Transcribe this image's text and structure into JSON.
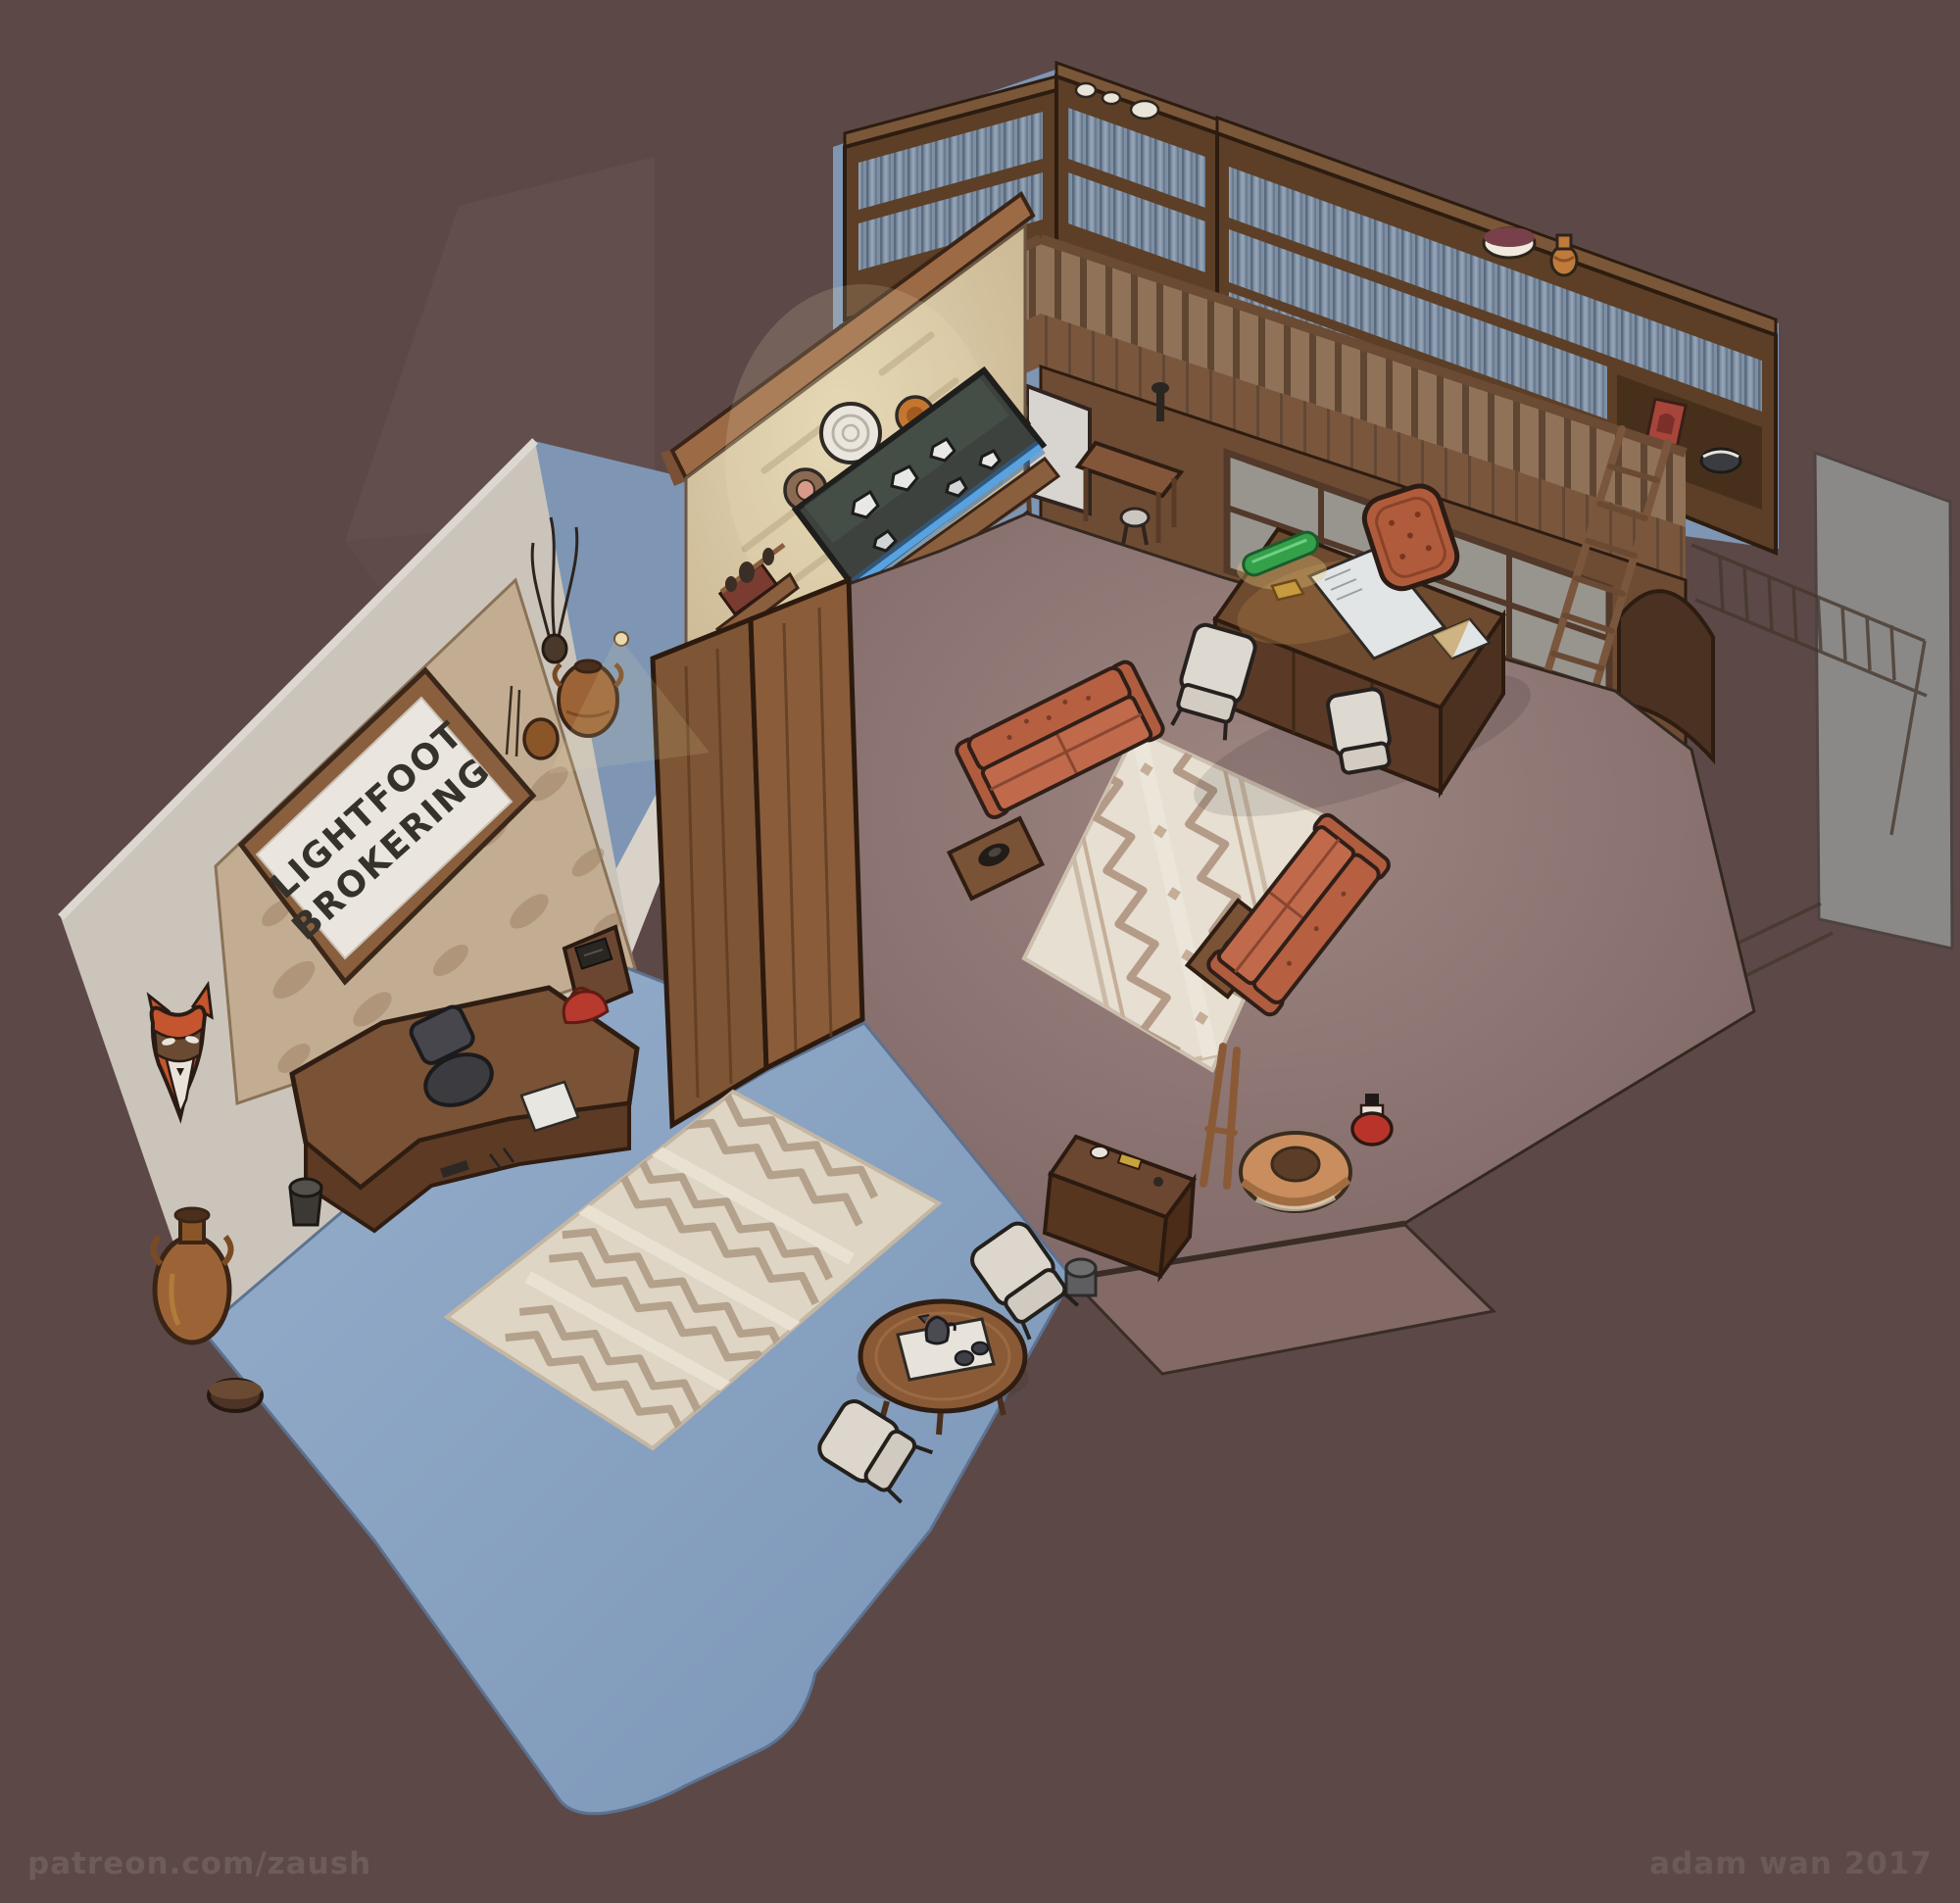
{
  "artwork": {
    "scene_title": "Lightfoot Brokering",
    "sign": {
      "line1": "LIGHTFOOT",
      "line2": "BROKERING"
    },
    "watermarks": {
      "left": "patreon.com/zaush",
      "right": "adam wan 2017"
    }
  },
  "palette": {
    "background": "#5c4947",
    "watermark_text": "#6e5c59",
    "left_wall": "#cbc4bb",
    "stone_sign_wall": "#c3ad92",
    "feature_stone_wall": "#d8c9a9",
    "sign_board": "#eae6df",
    "wood_dark": "#5c3f26",
    "wood_mid": "#825838",
    "wood_trim": "#9c6b46",
    "floor_blue": "#8ea8c8",
    "floor_mauve": "#8d7470",
    "rug_cream": "#e6dfd2",
    "rug_pattern": "#b49b88",
    "couch_terracotta": "#c06a4b",
    "books_blue": "#7e8fa3",
    "armchair_cream": "#dcd6cc",
    "display_glow": "#5aa8e8",
    "lamp_green": "#35a04a",
    "fox_mask_orange": "#c4552e",
    "accent_red": "#b8392e"
  },
  "scene": {
    "rooms": [
      {
        "name": "reception",
        "floor": "blue",
        "items": [
          "wall-sign",
          "fox-mask",
          "reception-desk",
          "office-chair",
          "patterned-rug",
          "coffee-table",
          "tea-tray",
          "armchairs",
          "floor-vase",
          "waste-bin"
        ]
      },
      {
        "name": "main-office",
        "floor": "mauve",
        "items": [
          "balcony-bookshelves",
          "railing",
          "ladder",
          "arched-alcove",
          "windows",
          "executive-desk",
          "bankers-lamp",
          "desk-chair",
          "guest-chairs",
          "sofas",
          "end-tables",
          "patterned-rug",
          "mineral-display-case",
          "stone-counter",
          "writing-desk",
          "stool",
          "wall-shelves",
          "basket",
          "red-jar",
          "easel",
          "console-table"
        ]
      }
    ],
    "unfinished_sketch_area": "right edge railing and panels drawn as pencil lines"
  }
}
